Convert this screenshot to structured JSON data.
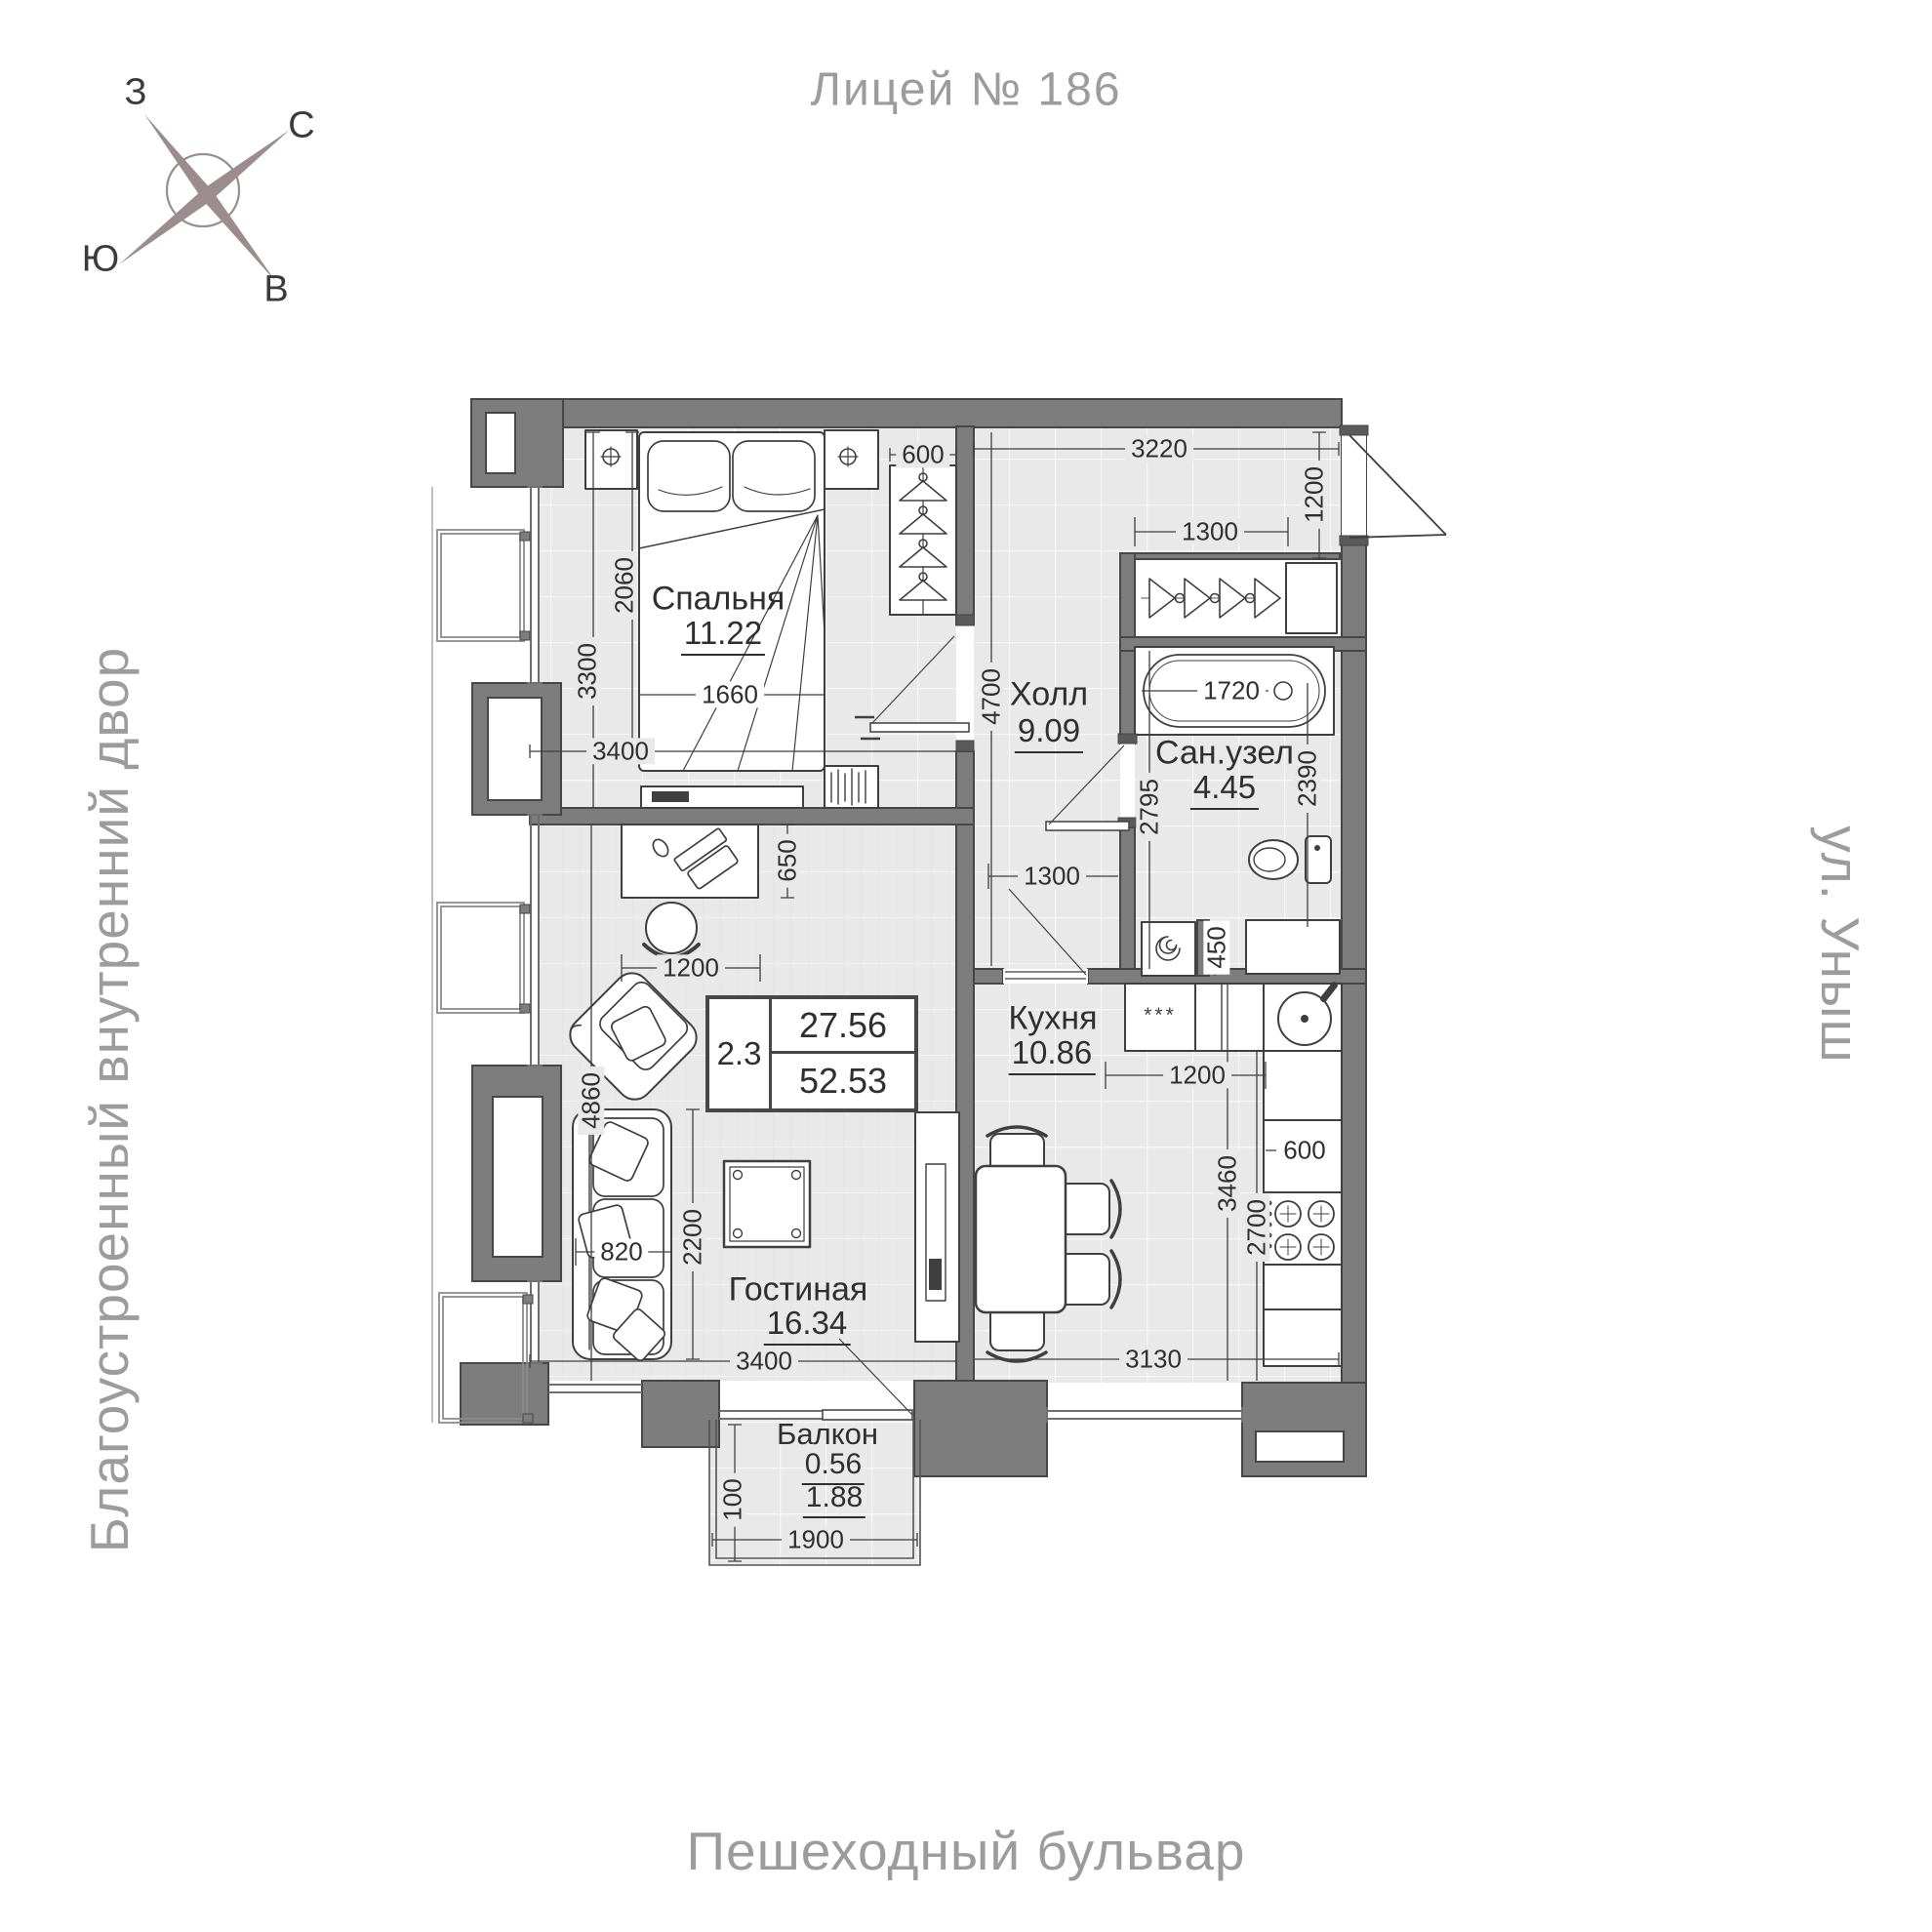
{
  "title": "Лицей № 186",
  "compass": {
    "west": "З",
    "north": "С",
    "south": "Ю",
    "east": "В"
  },
  "streets": {
    "left": "Благоустроенный внутренний двор",
    "right": "ул. Уныш",
    "bottom": "Пешеходный бульвар"
  },
  "rooms": [
    {
      "name": "Спальня",
      "area": "11.22"
    },
    {
      "name": "Холл",
      "area": "9.09"
    },
    {
      "name": "Сан.узел",
      "area": "4.45"
    },
    {
      "name": "Кухня",
      "area": "10.86"
    },
    {
      "name": "Гостиная",
      "area": "16.34"
    },
    {
      "name": "Балкон",
      "area": "0.56",
      "area_total": "1.88"
    }
  ],
  "summary": {
    "rooms": "2.3",
    "living_area": "27.56",
    "total_area": "52.53"
  },
  "kitchen": {
    "fridge_label": "***"
  },
  "dims": {
    "wardrobe_600": "600",
    "hall_3220": "3220",
    "entry_1200": "1200",
    "closet_1300": "1300",
    "bed_2060": "2060",
    "bedroom_3300": "3300",
    "bed_1660": "1660",
    "bedroom_3400": "3400",
    "hall_4700": "4700",
    "tub_1720": "1720",
    "bath_2390": "2390",
    "bath_2795": "2795",
    "hall_1300": "1300",
    "washer_450": "450",
    "desk_650": "650",
    "chair_1200": "1200",
    "living_4860": "4860",
    "sofa_820": "820",
    "living_2200": "2200",
    "living_3400": "3400",
    "kitchen_1200": "1200",
    "kitchen_3460": "3460",
    "kitchen_2700": "2700",
    "counter_600": "600",
    "kitchen_3130": "3130",
    "balcony_100": "100",
    "balcony_1900": "1900"
  },
  "colors": {
    "wall": "#7d7d7d",
    "wallline": "#474747",
    "floor": "#e9e9e9",
    "ink": "#2f2f2f",
    "muted": "#9c9c9c",
    "line": "#3f3f3f",
    "compass": "#9b8d8d"
  }
}
